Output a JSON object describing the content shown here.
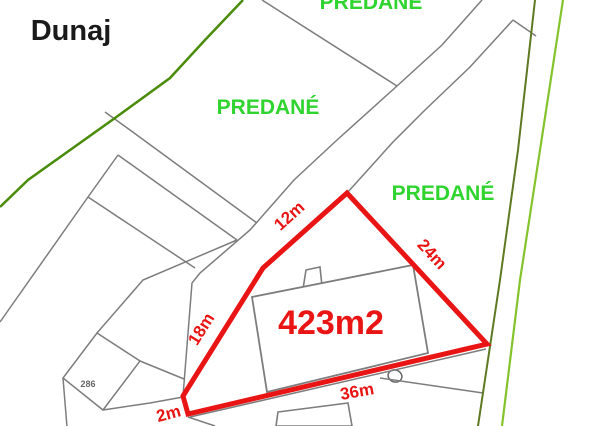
{
  "page_title": "Cadastral plan with highlighted plot",
  "colors": {
    "red": "#e91414",
    "green_text": "#2fd42f",
    "gray_line": "#7d7d7d",
    "gray_dark": "#666666",
    "green_left": "#4a8c0a",
    "olive_right": "#5d7a23",
    "bright_right": "#84c32b",
    "black": "#1a1a1a",
    "white": "#ffffff"
  },
  "map": {
    "width": 600,
    "height": 426,
    "plot": {
      "area_text": "423m2",
      "side_lengths": [
        "12m",
        "24m",
        "18m",
        "2m",
        "36m"
      ],
      "outline_points": [
        [
          347,
          193
        ],
        [
          263,
          268
        ],
        [
          183,
          396
        ],
        [
          188,
          414
        ],
        [
          487,
          344
        ]
      ]
    },
    "shapes": [
      {
        "name": "building-chimney",
        "type": "polygon",
        "points": [
          [
            303,
            289
          ],
          [
            306,
            270
          ],
          [
            320,
            267
          ],
          [
            322,
            286
          ]
        ],
        "fill": "#ffffff",
        "stroke": "gray_line",
        "width": 1.6
      },
      {
        "name": "building-main",
        "type": "polygon",
        "points": [
          [
            252,
            297
          ],
          [
            413,
            265
          ],
          [
            428,
            353
          ],
          [
            267,
            392
          ]
        ],
        "fill": "#ffffff",
        "stroke": "gray_line",
        "width": 1.8
      },
      {
        "name": "building-lower",
        "type": "polygon",
        "points": [
          [
            278,
            412
          ],
          [
            348,
            403
          ],
          [
            352,
            426
          ],
          [
            276,
            426
          ]
        ],
        "fill": "#ffffff",
        "stroke": "gray_line",
        "width": 1.6
      },
      {
        "name": "parcel-286-outline",
        "type": "polygon",
        "points": [
          [
            97,
            333
          ],
          [
            140,
            361
          ],
          [
            103,
            410
          ],
          [
            63,
            378
          ]
        ],
        "fill": "none",
        "stroke": "gray_line",
        "width": 1.5
      },
      {
        "name": "well-oval",
        "type": "ellipse",
        "cx": 395,
        "cy": 376,
        "rx": 7,
        "ry": 6,
        "rotate": 20,
        "fill": "#ffffff",
        "stroke": "gray_dark",
        "width": 1.5
      }
    ],
    "lines": [
      {
        "name": "top-parcel-line",
        "color": "gray_line",
        "width": 1.5,
        "points": [
          [
            262,
            0
          ],
          [
            397,
            86
          ]
        ]
      },
      {
        "name": "road-nw-edge",
        "color": "gray_line",
        "width": 1.5,
        "points": [
          [
            482,
            0
          ],
          [
            442,
            45
          ],
          [
            397,
            86
          ],
          [
            337,
            140
          ],
          [
            294,
            180
          ],
          [
            250,
            230
          ],
          [
            200,
            273
          ],
          [
            192,
            283
          ],
          [
            183,
            396
          ]
        ]
      },
      {
        "name": "road-se-edge",
        "color": "gray_line",
        "width": 1.5,
        "points": [
          [
            513,
            20
          ],
          [
            470,
            67
          ],
          [
            425,
            110
          ],
          [
            393,
            142
          ],
          [
            347,
            193
          ],
          [
            263,
            268
          ]
        ]
      },
      {
        "name": "road-spur-to-boundary",
        "color": "gray_line",
        "width": 1.5,
        "points": [
          [
            513,
            20
          ],
          [
            536,
            36
          ]
        ]
      },
      {
        "name": "side-path-edge-1",
        "color": "gray_line",
        "width": 1.5,
        "points": [
          [
            105,
            112
          ],
          [
            130,
            130
          ],
          [
            257,
            223
          ]
        ]
      },
      {
        "name": "side-path-edge-2",
        "color": "gray_line",
        "width": 1.5,
        "points": [
          [
            118,
            155
          ],
          [
            237,
            240
          ]
        ]
      },
      {
        "name": "west-boundary-line",
        "color": "gray_line",
        "width": 1.5,
        "points": [
          [
            118,
            155
          ],
          [
            88,
            197
          ],
          [
            0,
            322
          ]
        ]
      },
      {
        "name": "west-branch-line",
        "color": "gray_line",
        "width": 1.5,
        "points": [
          [
            88,
            197
          ],
          [
            195,
            268
          ]
        ]
      },
      {
        "name": "sw-path-upper",
        "color": "gray_line",
        "width": 1.5,
        "points": [
          [
            237,
            240
          ],
          [
            143,
            280
          ],
          [
            97,
            333
          ]
        ]
      },
      {
        "name": "sw-path-to-corner-upper",
        "color": "gray_line",
        "width": 1.5,
        "points": [
          [
            140,
            361
          ],
          [
            184,
            379
          ]
        ]
      },
      {
        "name": "sw-path-to-corner-lower",
        "color": "gray_line",
        "width": 1.5,
        "points": [
          [
            103,
            410
          ],
          [
            150,
            403
          ],
          [
            183,
            397
          ]
        ]
      },
      {
        "name": "sw-down-line",
        "color": "gray_line",
        "width": 1.5,
        "points": [
          [
            63,
            378
          ],
          [
            67,
            427
          ]
        ]
      },
      {
        "name": "bottom-stub-line",
        "color": "gray_line",
        "width": 1.5,
        "points": [
          [
            188,
            417
          ],
          [
            215,
            426
          ]
        ]
      },
      {
        "name": "boundary-to-olive",
        "color": "gray_line",
        "width": 1.5,
        "points": [
          [
            380,
            378
          ],
          [
            483,
            393
          ]
        ]
      },
      {
        "name": "under-36m-boundary",
        "color": "gray_line",
        "width": 1.5,
        "points": [
          [
            190,
            417
          ],
          [
            486,
            349
          ]
        ]
      },
      {
        "name": "green-boundary-left",
        "color": "green_left",
        "width": 2.5,
        "points": [
          [
            243,
            0
          ],
          [
            205,
            40
          ],
          [
            170,
            78
          ],
          [
            115,
            118
          ],
          [
            28,
            180
          ],
          [
            0,
            207
          ]
        ]
      },
      {
        "name": "olive-boundary-right",
        "color": "olive_right",
        "width": 2,
        "points": [
          [
            535,
            0
          ],
          [
            518,
            150
          ],
          [
            500,
            280
          ],
          [
            478,
            426
          ]
        ]
      },
      {
        "name": "bright-green-boundary-right",
        "color": "bright_right",
        "width": 2.2,
        "points": [
          [
            563,
            0
          ],
          [
            540,
            150
          ],
          [
            520,
            280
          ],
          [
            502,
            426
          ]
        ]
      },
      {
        "name": "plot-outline-red",
        "color": "red",
        "width": 5,
        "closed": true,
        "points": [
          [
            347,
            193
          ],
          [
            263,
            268
          ],
          [
            183,
            396
          ],
          [
            188,
            414
          ],
          [
            487,
            344
          ]
        ]
      }
    ],
    "labels": [
      {
        "name": "dunaj-label",
        "text": "Dunaj",
        "x": 71,
        "y": 40,
        "size": 29,
        "weight": "bold",
        "color": "black",
        "rotate": 0
      },
      {
        "name": "predane-label-top",
        "text": "PREDANÉ",
        "x": 371,
        "y": 9,
        "size": 21,
        "weight": "bold",
        "color": "green_text",
        "rotate": 0
      },
      {
        "name": "predane-label-left",
        "text": "PREDANÉ",
        "x": 268,
        "y": 114,
        "size": 21,
        "weight": "bold",
        "color": "green_text",
        "rotate": 0
      },
      {
        "name": "predane-label-right",
        "text": "PREDANÉ",
        "x": 443,
        "y": 200,
        "size": 21,
        "weight": "bold",
        "color": "green_text",
        "rotate": 0
      },
      {
        "name": "plot-area-label",
        "text": "423m2",
        "x": 331,
        "y": 334,
        "size": 34,
        "weight": "bold",
        "color": "red",
        "rotate": 0
      },
      {
        "name": "side-length-12m",
        "text": "12m",
        "x": 293,
        "y": 220,
        "size": 17,
        "weight": "bold",
        "color": "red",
        "rotate": -42
      },
      {
        "name": "side-length-24m",
        "text": "24m",
        "x": 428,
        "y": 258,
        "size": 17,
        "weight": "bold",
        "color": "red",
        "rotate": 47
      },
      {
        "name": "side-length-18m",
        "text": "18m",
        "x": 206,
        "y": 332,
        "size": 17,
        "weight": "bold",
        "color": "red",
        "rotate": -58
      },
      {
        "name": "side-length-2m",
        "text": "2m",
        "x": 170,
        "y": 419,
        "size": 17,
        "weight": "bold",
        "color": "red",
        "rotate": -15
      },
      {
        "name": "side-length-36m",
        "text": "36m",
        "x": 358,
        "y": 397,
        "size": 17,
        "weight": "bold",
        "color": "red",
        "rotate": -10
      },
      {
        "name": "parcel-number-286",
        "text": "286",
        "x": 88,
        "y": 387,
        "size": 9,
        "weight": "bold",
        "color": "gray_dark",
        "rotate": 0
      }
    ]
  }
}
